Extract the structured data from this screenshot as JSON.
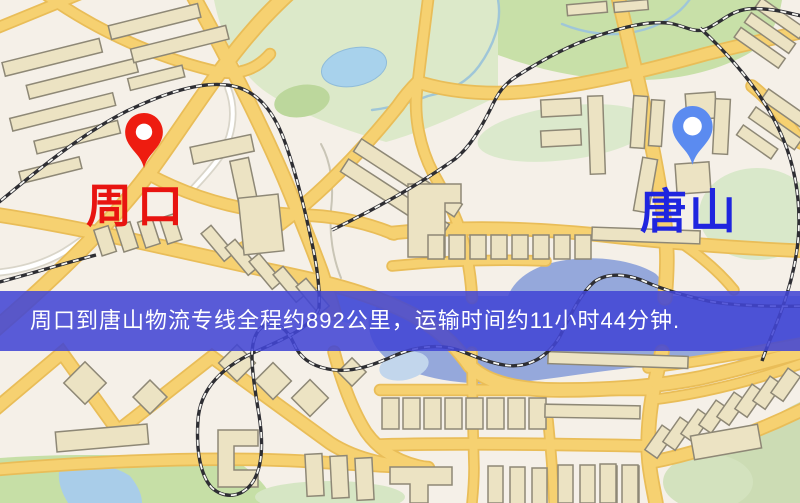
{
  "map": {
    "banner": {
      "text": "周口到唐山物流专线全程约892公里，运输时间约11小时44分钟.",
      "bg_color": "#4245d5",
      "text_color": "#ffffff"
    },
    "origin_marker": {
      "label": "周口",
      "label_color": "#e81410",
      "pin_color": "#ee1c10"
    },
    "destination_marker": {
      "label": "唐山",
      "label_color": "#1f25df",
      "pin_color": "#5b8bf0"
    },
    "route": {
      "origin": "周口",
      "destination": "唐山",
      "distance_km": 892,
      "duration_hours": 11,
      "duration_minutes": 44
    },
    "palette": {
      "background": "#f5f0e8",
      "road_yellow": "#f6d171",
      "road_casing": "#e9bd58",
      "park_green": "#c8e0a8",
      "pale_green": "#dbe9cc",
      "lake_blue": "#a8d2ec",
      "river_blue": "#95a8db",
      "railway_dark": "#2e2e33",
      "building_fill": "#ece3c3",
      "building_stroke": "#8e8876"
    }
  }
}
